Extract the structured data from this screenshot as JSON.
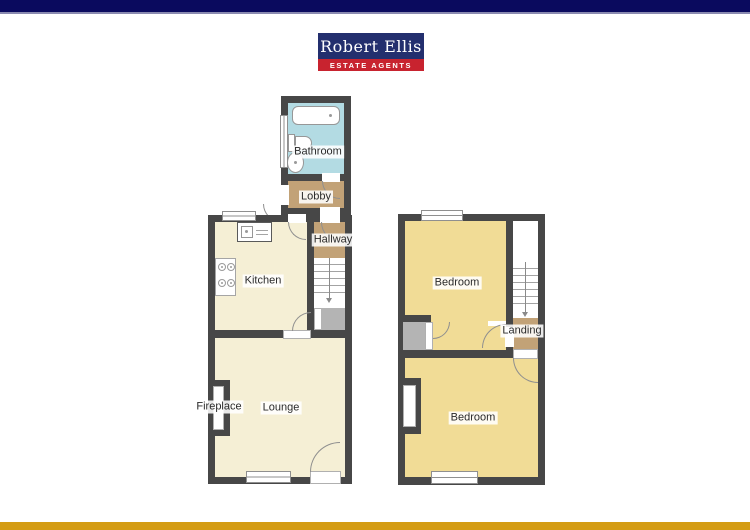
{
  "brand": {
    "name": "Robert Ellis",
    "tagline": "ESTATE AGENTS",
    "navy_color": "#232f6e",
    "red_color": "#c8232f"
  },
  "bars": {
    "top_color": "#0a0a5e",
    "bottom_color": "#d49c14"
  },
  "palette": {
    "wall": "#474747",
    "bathroom_floor": "#b3dbe3",
    "hall_floor": "#c2a277",
    "living_floor": "#f5efd5",
    "bedroom_floor": "#f1dc96",
    "cupboard_gray": "#b4b4b4"
  },
  "ground_floor": {
    "rooms": {
      "bathroom": {
        "label": "Bathroom"
      },
      "lobby": {
        "label": "Lobby"
      },
      "hallway": {
        "label": "Hallway"
      },
      "kitchen": {
        "label": "Kitchen"
      },
      "lounge": {
        "label": "Lounge"
      },
      "fireplace": {
        "label": "Fireplace"
      }
    }
  },
  "first_floor": {
    "rooms": {
      "bedroom_front": {
        "label": "Bedroom"
      },
      "bedroom_back": {
        "label": "Bedroom"
      },
      "landing": {
        "label": "Landing"
      }
    }
  }
}
